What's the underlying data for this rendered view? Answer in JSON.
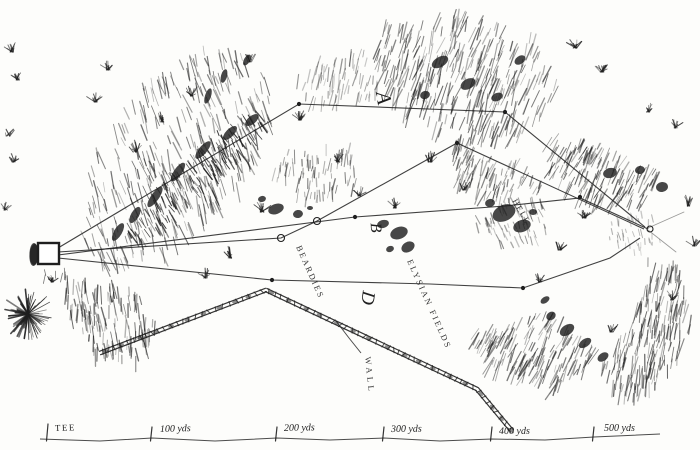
{
  "figure": {
    "kind": "engraved golf hole plan",
    "ink_color": "#1f1f1f",
    "paper_color": "#fdfdfb"
  },
  "labels": {
    "routes": [
      {
        "id": "route-a",
        "text": "A",
        "x": 377,
        "y": 99,
        "rotate": 80,
        "size": 21
      },
      {
        "id": "route-b",
        "text": "B",
        "x": 371,
        "y": 228,
        "rotate": 86,
        "size": 16
      },
      {
        "id": "route-d",
        "text": "D",
        "x": 362,
        "y": 297,
        "rotate": 98,
        "size": 19
      }
    ],
    "hazards": [
      {
        "id": "beardies",
        "text": "BEARDIES",
        "x": 296,
        "y": 247,
        "rotate": 66,
        "size": 8.5,
        "spacing": 2
      },
      {
        "id": "elysian-fields",
        "text": "ELYSIAN FIELDS",
        "x": 407,
        "y": 261,
        "rotate": 66,
        "size": 8.5,
        "spacing": 2.2
      },
      {
        "id": "wall",
        "text": "WALL",
        "x": 365,
        "y": 357,
        "rotate": 84,
        "size": 8.5,
        "spacing": 3.5
      },
      {
        "id": "hell",
        "text": "HELL",
        "x": 512,
        "y": 201,
        "rotate": 60,
        "size": 8.5,
        "spacing": 1.5
      }
    ],
    "scale": {
      "ticks": [
        {
          "x": 48,
          "label": "TEE",
          "caps": true,
          "lx": 55,
          "ly": 431
        },
        {
          "x": 152,
          "label": "100 yds",
          "lx": 160,
          "ly": 432
        },
        {
          "x": 277,
          "label": "200 yds",
          "lx": 284,
          "ly": 431
        },
        {
          "x": 384,
          "label": "300 yds",
          "lx": 391,
          "ly": 432
        },
        {
          "x": 492,
          "label": "400 yds",
          "lx": 499,
          "ly": 434
        },
        {
          "x": 594,
          "label": "500 yds",
          "lx": 604,
          "ly": 431
        }
      ]
    }
  },
  "map": {
    "tee": {
      "x": 38,
      "y": 243,
      "w": 21,
      "h": 21
    },
    "hole_ring": {
      "x": 650,
      "y": 229,
      "r": 3
    },
    "routes": [
      {
        "id": "A",
        "points": [
          [
            58,
            248
          ],
          [
            299,
            104
          ],
          [
            505,
            112
          ],
          [
            645,
            227
          ]
        ]
      },
      {
        "id": "A2",
        "points": [
          [
            58,
            252
          ],
          [
            281,
            238
          ],
          [
            317,
            221
          ],
          [
            457,
            143
          ],
          [
            644,
            229
          ]
        ]
      },
      {
        "id": "B",
        "points": [
          [
            58,
            255
          ],
          [
            355,
            217
          ],
          [
            505,
            206
          ],
          [
            580,
            198
          ],
          [
            648,
            229
          ]
        ]
      },
      {
        "id": "D",
        "points": [
          [
            58,
            258
          ],
          [
            272,
            280
          ],
          [
            430,
            284
          ],
          [
            523,
            288
          ],
          [
            610,
            258
          ],
          [
            640,
            238
          ]
        ]
      }
    ],
    "wall": {
      "points": [
        [
          100,
          353
        ],
        [
          266,
          290
        ],
        [
          477,
          389
        ],
        [
          512,
          431
        ]
      ]
    },
    "wall_leader": [
      [
        336,
        321
      ],
      [
        349,
        338
      ],
      [
        361,
        353
      ]
    ],
    "green_sketch": [
      [
        [
          648,
          228
        ],
        [
          684,
          212
        ]
      ],
      [
        [
          648,
          230
        ],
        [
          676,
          252
        ]
      ]
    ],
    "dots": [
      [
        299,
        104
      ],
      [
        505,
        112
      ],
      [
        457,
        143
      ],
      [
        355,
        217
      ],
      [
        580,
        197
      ],
      [
        272,
        280
      ],
      [
        523,
        288
      ]
    ],
    "rings": [
      [
        281,
        238
      ],
      [
        317,
        221
      ]
    ],
    "baseline": [
      [
        40,
        439
      ],
      [
        100,
        441
      ],
      [
        152,
        438
      ],
      [
        215,
        441
      ],
      [
        277,
        438
      ],
      [
        330,
        440
      ],
      [
        384,
        438
      ],
      [
        440,
        441
      ],
      [
        492,
        439
      ],
      [
        545,
        440
      ],
      [
        594,
        437
      ],
      [
        660,
        434
      ]
    ],
    "blobs": [
      [
        276,
        209,
        8,
        5,
        -20
      ],
      [
        298,
        214,
        5,
        4,
        -10
      ],
      [
        262,
        199,
        4,
        3,
        -15
      ],
      [
        310,
        208,
        3,
        2,
        0
      ],
      [
        383,
        224,
        6,
        4,
        -15
      ],
      [
        399,
        233,
        9,
        6,
        -20
      ],
      [
        408,
        247,
        7,
        5,
        -30
      ],
      [
        390,
        249,
        4,
        3,
        -20
      ],
      [
        504,
        213,
        12,
        8,
        -25
      ],
      [
        522,
        226,
        9,
        6,
        -20
      ],
      [
        490,
        203,
        5,
        4,
        -15
      ],
      [
        533,
        212,
        4,
        3,
        0
      ],
      [
        610,
        173,
        7,
        5,
        -15
      ],
      [
        640,
        170,
        5,
        4,
        -10
      ],
      [
        662,
        187,
        6,
        5,
        -10
      ],
      [
        567,
        330,
        8,
        5,
        -35
      ],
      [
        585,
        343,
        7,
        4,
        -35
      ],
      [
        551,
        316,
        5,
        4,
        -35
      ],
      [
        603,
        357,
        6,
        4,
        -35
      ],
      [
        545,
        300,
        5,
        3,
        -35
      ],
      [
        118,
        232,
        10,
        4,
        -60
      ],
      [
        135,
        215,
        9,
        4,
        -60
      ],
      [
        155,
        197,
        12,
        4,
        -55
      ],
      [
        178,
        172,
        11,
        4,
        -55
      ],
      [
        203,
        150,
        11,
        4,
        -50
      ],
      [
        230,
        133,
        9,
        4,
        -45
      ],
      [
        252,
        120,
        8,
        4,
        -40
      ],
      [
        208,
        96,
        8,
        3,
        -72
      ],
      [
        224,
        76,
        7,
        3,
        -75
      ],
      [
        247,
        60,
        6,
        3,
        -60
      ],
      [
        440,
        62,
        9,
        5,
        -30
      ],
      [
        468,
        84,
        8,
        5,
        -30
      ],
      [
        497,
        97,
        6,
        4,
        -25
      ],
      [
        425,
        95,
        5,
        4,
        -20
      ],
      [
        520,
        60,
        6,
        4,
        -35
      ],
      [
        34,
        255,
        4.5,
        11,
        4
      ]
    ],
    "hatch_regions": [
      {
        "poly": [
          [
            78,
            235
          ],
          [
            92,
            150
          ],
          [
            140,
            82
          ],
          [
            205,
            42
          ],
          [
            262,
            55
          ],
          [
            272,
            118
          ],
          [
            238,
            185
          ],
          [
            165,
            248
          ],
          [
            105,
            265
          ]
        ],
        "angle": 72,
        "len": 15,
        "n": 330,
        "o": 0.5
      },
      {
        "poly": [
          [
            120,
            230
          ],
          [
            160,
            180
          ],
          [
            215,
            130
          ],
          [
            255,
            105
          ],
          [
            265,
            130
          ],
          [
            225,
            165
          ],
          [
            170,
            215
          ],
          [
            140,
            245
          ]
        ],
        "angle": 60,
        "len": 10,
        "n": 160,
        "o": 0.7
      },
      {
        "poly": [
          [
            62,
            272
          ],
          [
            130,
            282
          ],
          [
            158,
            320
          ],
          [
            138,
            358
          ],
          [
            96,
            352
          ],
          [
            70,
            318
          ]
        ],
        "angle": 85,
        "len": 13,
        "n": 140,
        "o": 0.55
      },
      {
        "poly": [
          [
            382,
            18
          ],
          [
            462,
            8
          ],
          [
            540,
            35
          ],
          [
            562,
            88
          ],
          [
            525,
            132
          ],
          [
            455,
            142
          ],
          [
            402,
            105
          ],
          [
            376,
            55
          ]
        ],
        "angle": 108,
        "len": 16,
        "n": 330,
        "o": 0.5
      },
      {
        "poly": [
          [
            455,
            142
          ],
          [
            520,
            158
          ],
          [
            545,
            185
          ],
          [
            505,
            200
          ],
          [
            458,
            180
          ]
        ],
        "angle": 110,
        "len": 12,
        "n": 90,
        "o": 0.45
      },
      {
        "poly": [
          [
            552,
            128
          ],
          [
            618,
            148
          ],
          [
            662,
            172
          ],
          [
            645,
            205
          ],
          [
            585,
            198
          ],
          [
            548,
            166
          ]
        ],
        "angle": 115,
        "len": 14,
        "n": 150,
        "o": 0.5
      },
      {
        "poly": [
          [
            648,
            252
          ],
          [
            688,
            262
          ],
          [
            692,
            325
          ],
          [
            662,
            382
          ],
          [
            622,
            398
          ],
          [
            602,
            362
          ],
          [
            632,
            318
          ],
          [
            645,
            282
          ]
        ],
        "angle": 100,
        "len": 15,
        "n": 200,
        "o": 0.5
      },
      {
        "poly": [
          [
            470,
            328
          ],
          [
            558,
            308
          ],
          [
            600,
            350
          ],
          [
            558,
            388
          ],
          [
            492,
            362
          ]
        ],
        "angle": 115,
        "len": 14,
        "n": 160,
        "o": 0.5
      },
      {
        "poly": [
          [
            480,
            196
          ],
          [
            540,
            196
          ],
          [
            552,
            238
          ],
          [
            506,
            246
          ],
          [
            474,
            222
          ]
        ],
        "angle": 70,
        "len": 8,
        "n": 70,
        "o": 0.4
      },
      {
        "poly": [
          [
            282,
            148
          ],
          [
            352,
            142
          ],
          [
            360,
            182
          ],
          [
            305,
            200
          ],
          [
            272,
            175
          ]
        ],
        "angle": 95,
        "len": 10,
        "n": 80,
        "o": 0.45
      },
      {
        "poly": [
          [
            300,
            58
          ],
          [
            368,
            44
          ],
          [
            380,
            92
          ],
          [
            330,
            108
          ],
          [
            296,
            88
          ]
        ],
        "angle": 100,
        "len": 12,
        "n": 70,
        "o": 0.35
      },
      {
        "poly": [
          [
            612,
            208
          ],
          [
            652,
            212
          ],
          [
            660,
            240
          ],
          [
            636,
            252
          ],
          [
            608,
            236
          ]
        ],
        "angle": 80,
        "len": 6,
        "n": 40,
        "o": 0.3
      }
    ],
    "tufts": [
      [
        135,
        152,
        9
      ],
      [
        162,
        122,
        8
      ],
      [
        192,
        96,
        8
      ],
      [
        250,
        62,
        7
      ],
      [
        300,
        120,
        7
      ],
      [
        338,
        162,
        8
      ],
      [
        262,
        212,
        8
      ],
      [
        230,
        258,
        9
      ],
      [
        205,
        278,
        8
      ],
      [
        108,
        70,
        7
      ],
      [
        95,
        102,
        7
      ],
      [
        575,
        48,
        8
      ],
      [
        602,
        72,
        8
      ],
      [
        648,
        112,
        8
      ],
      [
        676,
        128,
        7
      ],
      [
        688,
        206,
        8
      ],
      [
        694,
        246,
        7
      ],
      [
        672,
        300,
        8
      ],
      [
        612,
        332,
        8
      ],
      [
        584,
        218,
        7
      ],
      [
        430,
        162,
        8
      ],
      [
        464,
        190,
        7
      ],
      [
        360,
        196,
        7
      ],
      [
        395,
        208,
        7
      ],
      [
        52,
        282,
        6
      ],
      [
        12,
        52,
        7
      ],
      [
        18,
        80,
        6
      ],
      [
        8,
        136,
        6
      ],
      [
        14,
        162,
        6
      ],
      [
        6,
        210,
        6
      ],
      [
        560,
        250,
        7
      ],
      [
        540,
        282,
        7
      ]
    ],
    "bush": {
      "x": 28,
      "y": 314,
      "r": 26
    }
  }
}
